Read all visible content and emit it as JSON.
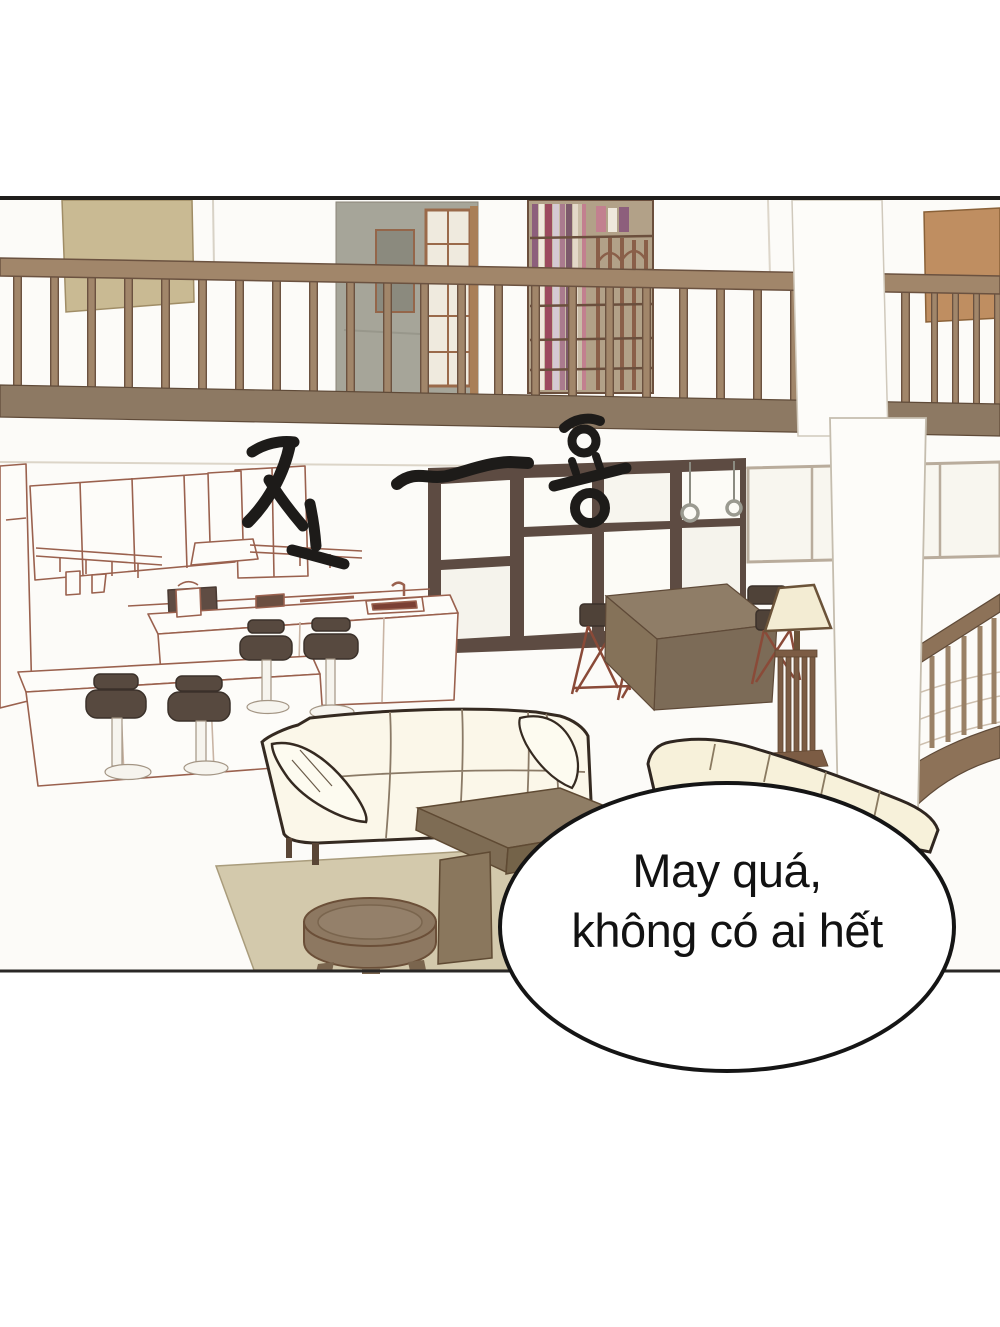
{
  "page": {
    "width": 1000,
    "height": 1327,
    "background": "#ffffff"
  },
  "panel": {
    "kind": "webtoon comic panel",
    "border_color": "#201e1c",
    "artwork_background": "#fcfbf8"
  },
  "scene": {
    "description": "Empty loft apartment interior: upstairs balcony railing with bookshelf and hallway, kitchen with bar counter and stools, large window wall, dining table with chairs, floor lamp, two cream sofas, coffee table, round stool, rug and a staircase"
  },
  "sfx": {
    "text": "조~용",
    "style": "large hand-drawn black strokes"
  },
  "speech_bubble": {
    "lines": [
      "May quá,",
      "không có ai hết"
    ],
    "fill": "#ffffff",
    "stroke": "#151515",
    "text_color": "#121212"
  },
  "colors": {
    "railing_wood": "#a1866a",
    "railing_outline": "#6b5240",
    "balcony_band": "#8d7963",
    "wall_painting": "#c9ba93",
    "right_wall_panel": "#bf8e61",
    "hallway_wall": "#a6a599",
    "bookshelf_back": "#b2a188",
    "window_frame": "#5d4b42",
    "kitchen_lineart": "#9a614e",
    "stool_seat": "#57493f",
    "dining_table": "#8f7d67",
    "lamp_shade": "#f3ecd3",
    "lamp_wood": "#7c5c44",
    "sofa_cream": "#fbf7e9",
    "sofa_outline": "#352a21",
    "coffee_table": "#8f7d65",
    "round_stool": "#8d7861",
    "rug": "#d3c9ac",
    "sfx_ink": "#1d1b19"
  }
}
